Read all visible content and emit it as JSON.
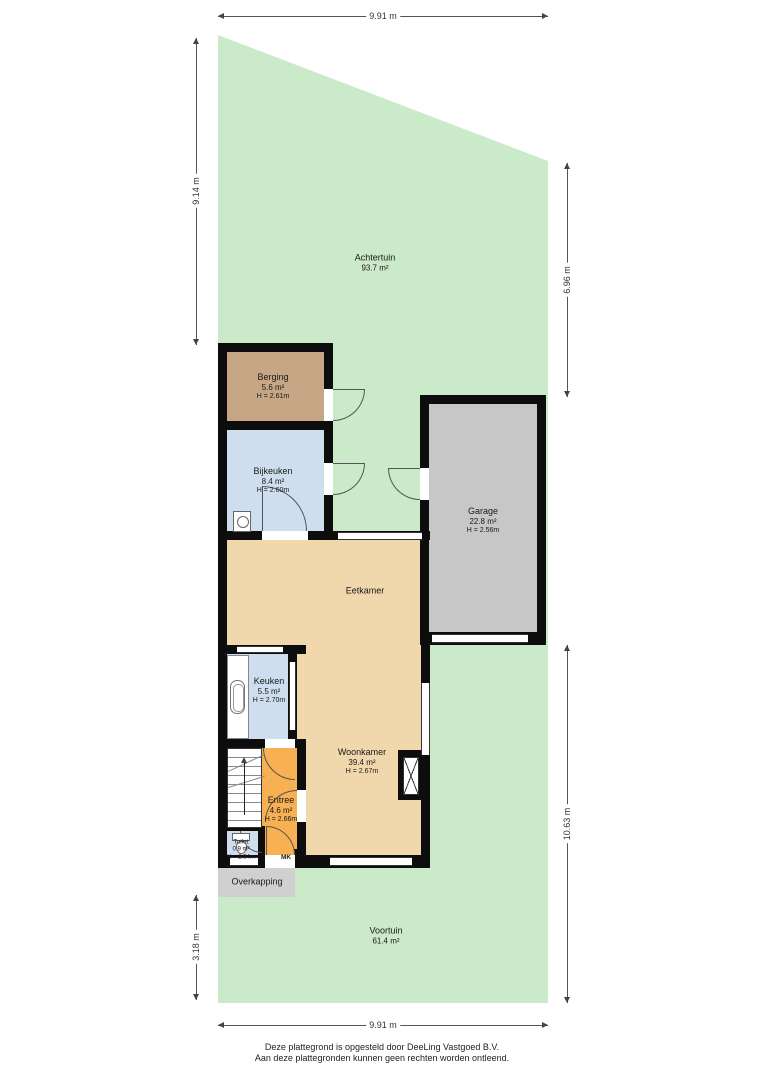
{
  "rooms": {
    "achtertuin": {
      "name": "Achtertuin",
      "area": "93.7 m²"
    },
    "berging": {
      "name": "Berging",
      "area": "5.6 m²",
      "height": "H = 2.61m"
    },
    "bijkeuken": {
      "name": "Bijkeuken",
      "area": "8.4 m²",
      "height": "H = 2.60m"
    },
    "garage": {
      "name": "Garage",
      "area": "22.8 m²",
      "height": "H = 2.56m"
    },
    "eetkamer": {
      "name": "Eetkamer"
    },
    "keuken": {
      "name": "Keuken",
      "area": "5.5 m²",
      "height": "H = 2.70m"
    },
    "woonkamer": {
      "name": "Woonkamer",
      "area": "39.4 m²",
      "height": "H = 2.67m"
    },
    "entree": {
      "name": "Entree",
      "area": "4.6 m²",
      "height": "H = 2.66m"
    },
    "toilet": {
      "name": "Toilet",
      "area": "0.9 m²",
      "height": "H = 2.34m"
    },
    "mk": {
      "name": "MK"
    },
    "overkapping": {
      "name": "Overkapping"
    },
    "voortuin": {
      "name": "Voortuin",
      "area": "61.4 m²"
    }
  },
  "dimensions": {
    "top": "9.91 m",
    "bottom": "9.91 m",
    "left_upper": "9.14 m",
    "left_lower": "3.18 m",
    "right_upper": "6.96 m",
    "right_lower": "10.63 m"
  },
  "footer": {
    "line1": "Deze plattegrond is opgesteld door DeeLing Vastgoed B.V.",
    "line2": "Aan deze plattegronden kunnen geen rechten worden ontleend."
  },
  "colors": {
    "garden": "#cbeac9",
    "living_floor": "#f0d7ac",
    "wet_room_floor": "#cedeee",
    "storage_floor": "#c6a685",
    "entry_floor": "#f7b152",
    "garage_floor": "#c7c7c7",
    "canopy": "#d0d0d0",
    "wall": "#0d0d0d"
  }
}
